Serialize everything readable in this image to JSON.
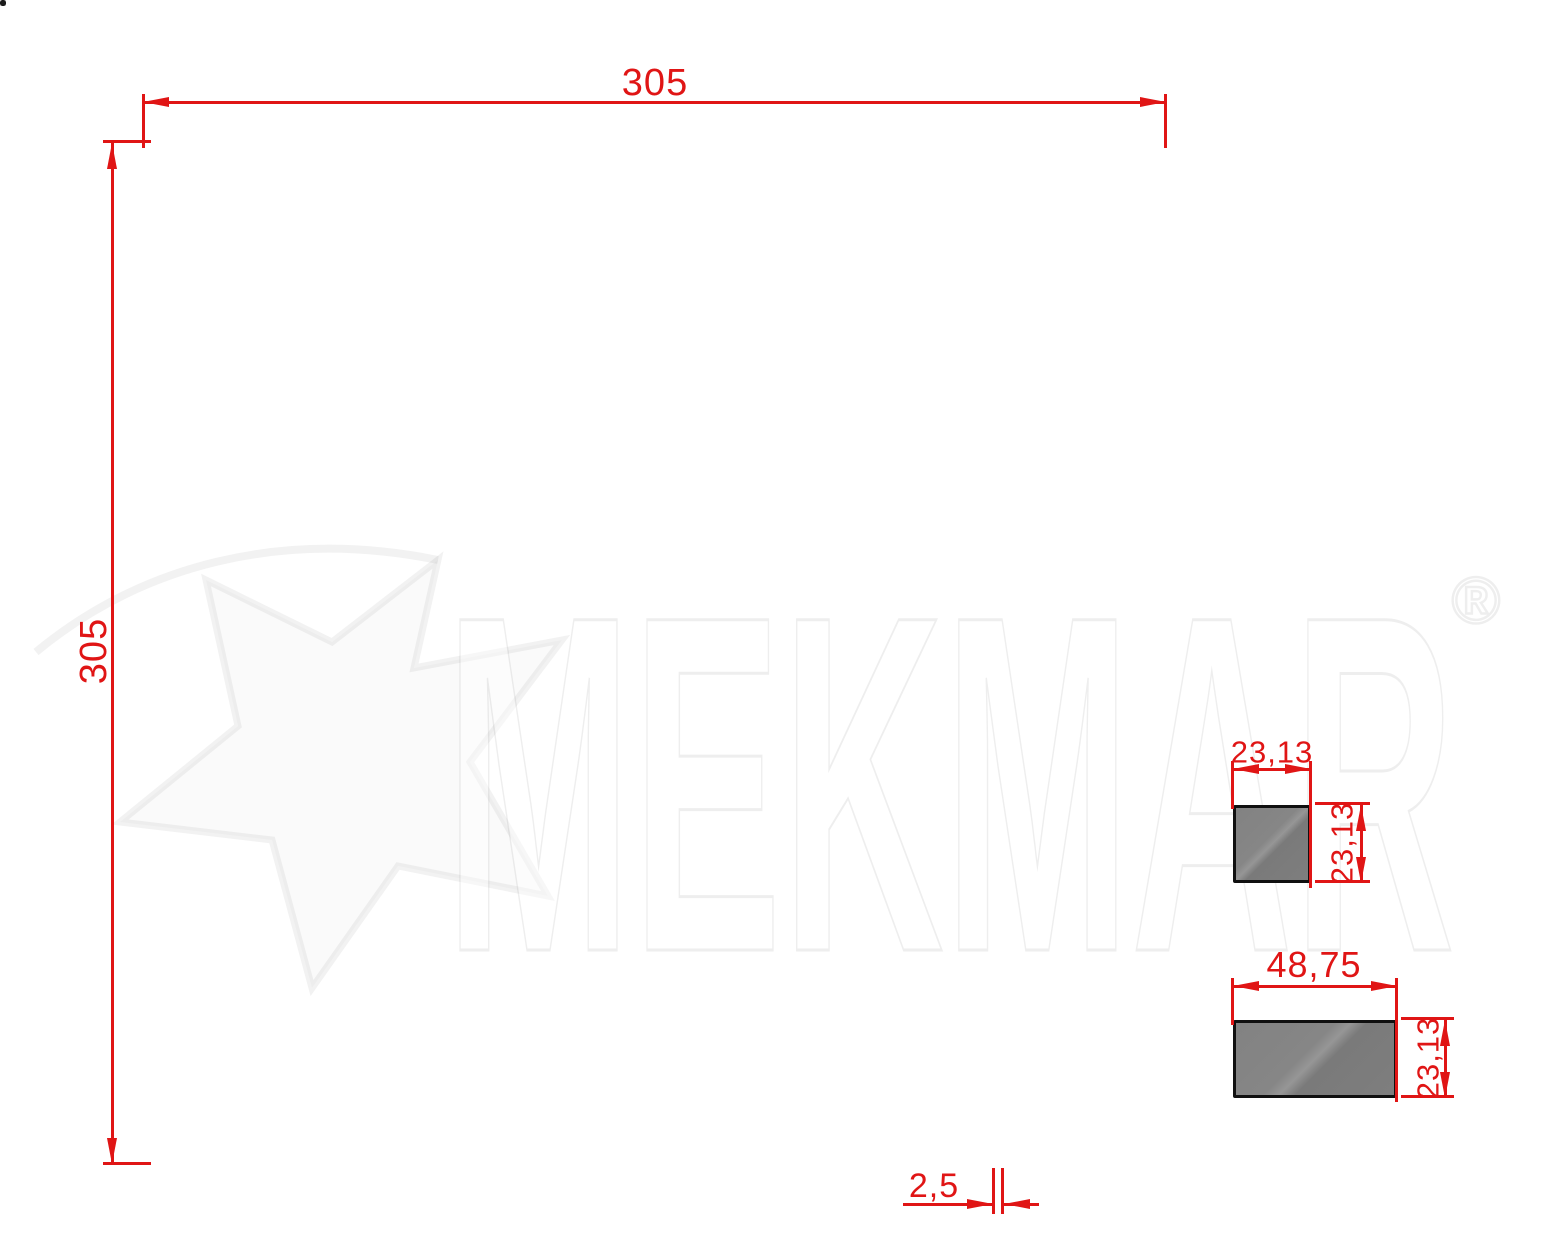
{
  "drawing": {
    "dimensions": {
      "top_width": "305",
      "left_height": "305",
      "tile_gap": "2,5",
      "square_width": "23,13",
      "square_height": "23,13",
      "rect_width": "48,75",
      "rect_height": "23,13"
    },
    "geometry_mm": {
      "overall": 305,
      "rect_length": 48.75,
      "rect_width": 23.13,
      "square": 23.13,
      "gap": 2.5,
      "cell_pitch": 76.25,
      "grid_cells": 4
    },
    "colors": {
      "dimension_red": "#e01515",
      "line_black": "#1b1b1b",
      "tile_fill": "#ffffff",
      "detail_gray": "#7e7e7e",
      "watermark_gray": "#ebebeb"
    }
  },
  "watermark": {
    "brand": "MEKMAR",
    "registered": "®"
  }
}
